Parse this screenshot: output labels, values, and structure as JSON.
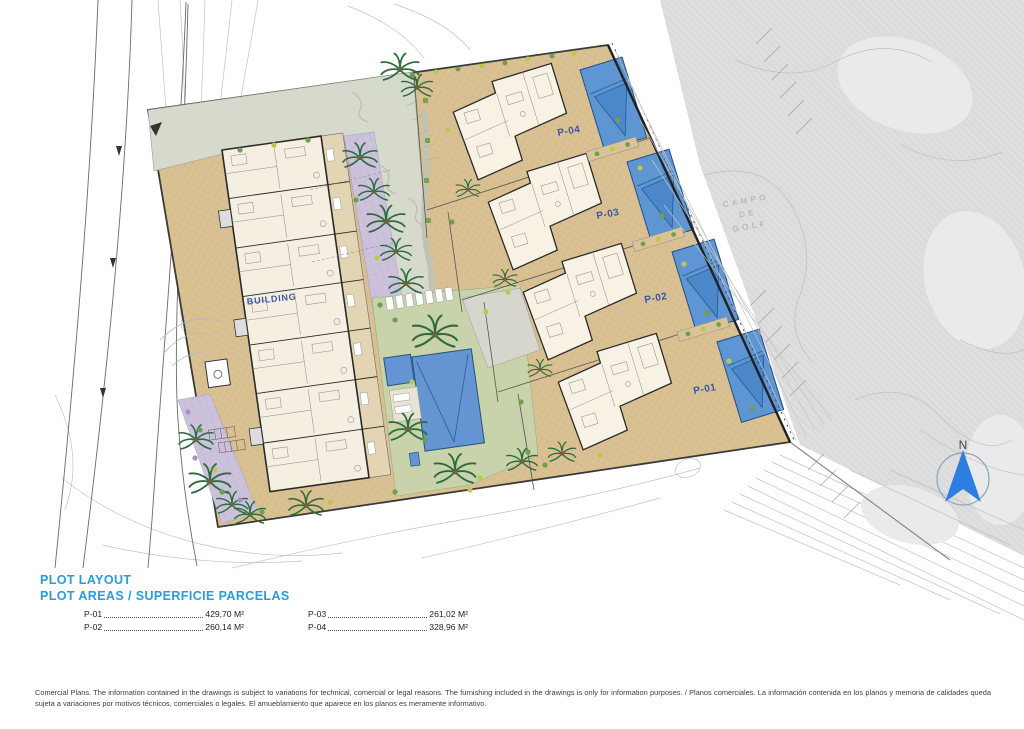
{
  "plan": {
    "labels": {
      "building": "BUILDING",
      "p01": "P-01",
      "p02": "P-02",
      "p03": "P-03",
      "p04": "P-04",
      "golf": [
        "CAMPO",
        "DE",
        "GOLF"
      ],
      "north": "N"
    },
    "colors": {
      "plot_paving_tan": "#d9c194",
      "pool_blue": "#5e95d3",
      "lawn_green": "#c9d3ab",
      "plaza_gray": "#d6dacd",
      "golf_gray": "#dedede",
      "plot_label_blue": "#3a56a8",
      "north_arrow_blue": "#2e7de0"
    }
  },
  "legend": {
    "title": "PLOT LAYOUT",
    "subtitle": "PLOT AREAS / SUPERFICIE PARCELAS",
    "title_color": "#2b9cd8",
    "plots": [
      {
        "id": "P-01",
        "area": "429,70 M²"
      },
      {
        "id": "P-02",
        "area": "260,14 M²"
      },
      {
        "id": "P-03",
        "area": "261,02 M²"
      },
      {
        "id": "P-04",
        "area": "328,96 M²"
      }
    ]
  },
  "disclaimer": {
    "en": "Comercial Plans. The information contained in the drawings is subject to variations for technical, comercial or legal reasons. The furnishing included in the drawings is only for information purposes. /",
    "es": "Planos comerciales. La información contenida en los planos y memoria de calidades queda sujeta a variaciones por motivos técnicos, comerciales o legales. El amueblamiento que aparece en los planos es meramente informativo."
  }
}
